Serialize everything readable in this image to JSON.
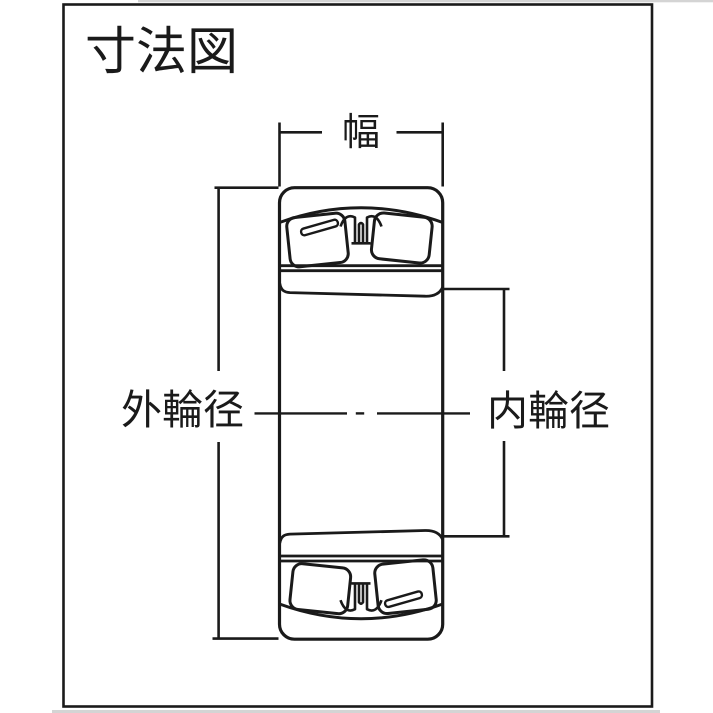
{
  "diagram": {
    "title": "寸法図",
    "labels": {
      "width": "幅",
      "outer_diameter": "外輪径",
      "inner_diameter": "内輪径"
    },
    "colors": {
      "line": "#1a1a1a",
      "background": "#ffffff"
    }
  }
}
